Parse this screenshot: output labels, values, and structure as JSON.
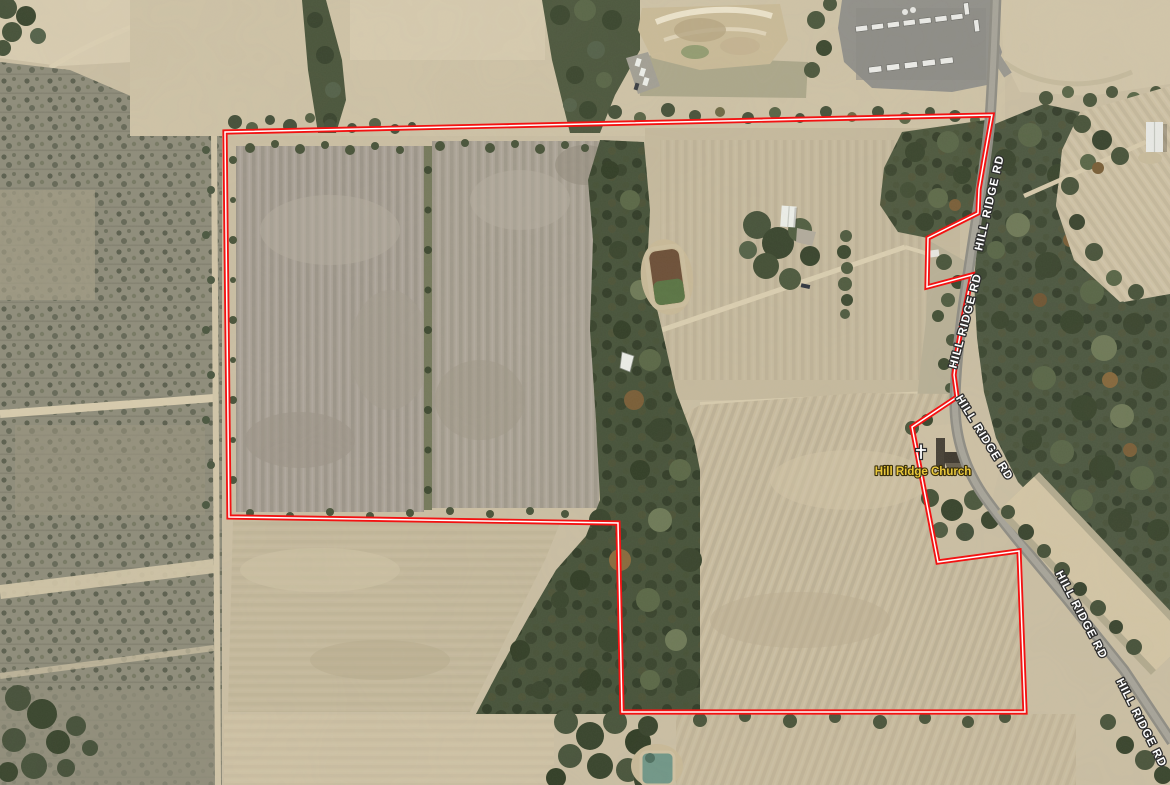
{
  "map": {
    "type": "aerial-parcel-map",
    "boundary": {
      "points": "225,132 992,115 984,160 979,189 978,213 928,238 927,287 972,275 963,318 957,352 954,375 957,397 912,427 938,562 1019,551 1025,712 622,712 618,523 229,517",
      "line_color": "#f31212",
      "core_color": "#ffffff"
    },
    "road_labels": [
      {
        "text": "HILL RIDGE RD",
        "transform": "translate(990,203) rotate(-77)"
      },
      {
        "text": "HILL RIDGE RD",
        "transform": "translate(966,321) rotate(-75)"
      },
      {
        "text": "HILL RIDGE RD",
        "transform": "translate(984,438) rotate(58)"
      },
      {
        "text": "HILL RIDGE RD",
        "transform": "translate(1081,615) rotate(62)"
      },
      {
        "text": "HILL RIDGE RD",
        "transform": "translate(1141,723) rotate(63)"
      }
    ],
    "poi_labels": [
      {
        "text": "Hill Ridge Church",
        "transform": "translate(923,472)"
      }
    ],
    "label_colors": {
      "road_text": "#ffffff",
      "road_outline": "#2e2e2e",
      "poi_text": "#e9c73b",
      "poi_outline": "#3a300d"
    }
  }
}
